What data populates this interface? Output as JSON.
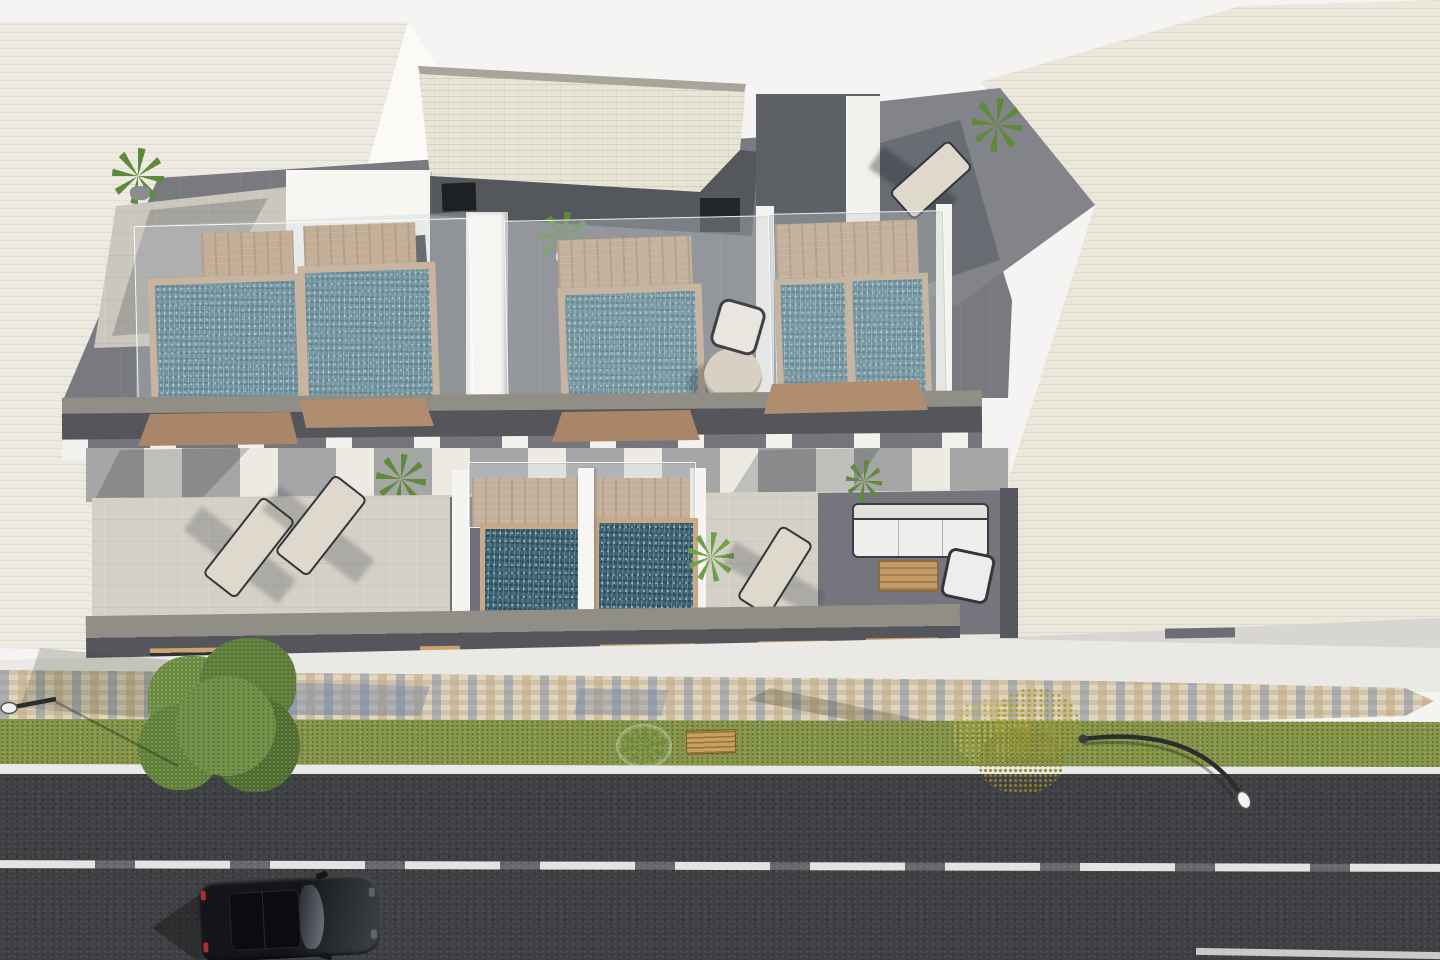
{
  "meta": {
    "type": "3d-architectural-exterior-render",
    "view": "aerial oblique top-down",
    "description": "Aerial 3D render of a modern two-storey residential building with rooftop plunge pools and terraces, flanked by cream neighbour buildings, fronted by a mosaic sidewalk, lawn strip with trees and benches, street lamps, and an asphalt road with a black car.",
    "image_size": {
      "width": 1440,
      "height": 960
    }
  },
  "palette": {
    "background": "#f5f4f2",
    "neighbor_left": "#edeae2",
    "neighbor_left_lit_face": "#fbfaf7",
    "neighbor_right": "#ebe7db",
    "roof_paving_dark": "#797a80",
    "roof_paving_light": "#cbc7bd",
    "penthouse_roof": "#e9e5d6",
    "penthouse_wall_dark": "#54575b",
    "opening_dark": "#24272a",
    "wood_deck": "#c2a07e",
    "pool_rim_wood": "#c9a888",
    "water_roof": "#4f7d8d",
    "water_lower": "#3d6474",
    "glass_balustrade": "rgba(198,208,212,0.34)",
    "level2_floor": "#d4d0c6",
    "level2_floor_dark": "#6e7077",
    "fascia_lit": "#908e85",
    "fascia_dark": "#54565b",
    "sidewalk": "#eae9e5",
    "mosaic_base": "#cfc2a8",
    "mosaic_blue": "#8d9ab3",
    "grass": "#87964a",
    "road": "#3f4043",
    "road_line": "#e3e3e1",
    "tree_green": "#5d7d3a",
    "tree_yellow": "#bfb148",
    "car_body": "#17181b",
    "sofa_white": "#eef0ee",
    "table_wood": "#c59a66"
  },
  "scene": {
    "neighbor_building_left": {
      "material": "cream brick",
      "position": "upper-left, diagonal edge"
    },
    "neighbor_building_right": {
      "material": "beige brick",
      "position": "upper-right, diagonal edge"
    },
    "main_building": {
      "roof_level": {
        "penthouse": {
          "roof": "cream brick",
          "walls": "dark grey",
          "stair_doors": 2
        },
        "terraces": [
          {
            "id": 1,
            "pools": 2,
            "features": [
              "wood deck steps",
              "glass balustrade"
            ]
          },
          {
            "id": 2,
            "pools": 1,
            "features": [
              "wood deck",
              "glass balustrade",
              "round table",
              "chair"
            ]
          },
          {
            "id": 3,
            "pools": 2,
            "features": [
              "wood deck",
              "glass balustrade",
              "palm plant"
            ]
          }
        ],
        "northeast_terrace": {
          "furniture": [
            "sun lounger"
          ],
          "plants": 1
        },
        "potted_plants": 3
      },
      "second_level": {
        "terrace_furniture": [
          "2 sun loungers",
          "1 sun lounger",
          "outdoor sofa",
          "armchair",
          "wood coffee table"
        ],
        "plunge_pool": {
          "basins": 2,
          "deck": "wood",
          "divider": "white wall"
        },
        "plants": 3,
        "fascia_windows": 6
      }
    },
    "streetscape": {
      "sidewalk": "light concrete",
      "mosaic_walk": "tan / blue-grey tile mosaic band",
      "lawn_strip": {
        "trees": [
          {
            "type": "green leafy",
            "x": 220
          },
          {
            "type": "yellow autumn",
            "x": 1010
          }
        ],
        "shrub_with_flowers": 1,
        "wooden_bench": 1
      },
      "street_lamps": 2,
      "road": {
        "surface": "asphalt",
        "edge_line": "white",
        "lane_line": "white, worn"
      },
      "car": {
        "color": "black",
        "orientation": "nose pointing right",
        "features": [
          "panoramic sunroof",
          "side mirrors"
        ]
      }
    }
  }
}
